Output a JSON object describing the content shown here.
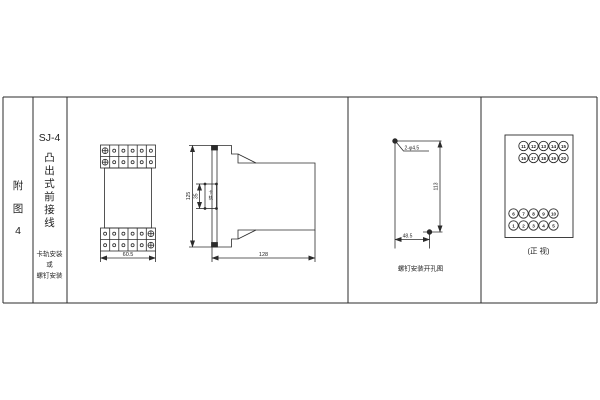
{
  "figure": {
    "figure_label_chars": [
      "附",
      "图",
      "4"
    ],
    "model": "SJ-4",
    "type_chars": [
      "凸",
      "出",
      "式",
      "前",
      "接",
      "线"
    ],
    "mount_note_lines": [
      "卡轨安装",
      "或",
      "螺钉安装"
    ]
  },
  "front_view": {
    "width_dim": "60.5"
  },
  "side_view": {
    "height_dim": "125",
    "rail_dim": "35",
    "rail_label_chars": [
      "卡",
      "轨"
    ],
    "depth_dim": "128"
  },
  "mounting_diagram": {
    "holes_label": "2-φ4.5",
    "vertical_dim": "113",
    "horizontal_dim": "48.5",
    "caption": "螺钉安装开孔图"
  },
  "terminal_view": {
    "caption": "(正 视)",
    "top_row1": [
      "11",
      "12",
      "13",
      "14",
      "15"
    ],
    "top_row2": [
      "16",
      "17",
      "18",
      "19",
      "20"
    ],
    "bottom_row1": [
      "6",
      "7",
      "8",
      "9",
      "10"
    ],
    "bottom_row2": [
      "1",
      "2",
      "3",
      "4",
      "5"
    ]
  },
  "colors": {
    "line": "#2b2b2b",
    "background": "#ffffff"
  }
}
